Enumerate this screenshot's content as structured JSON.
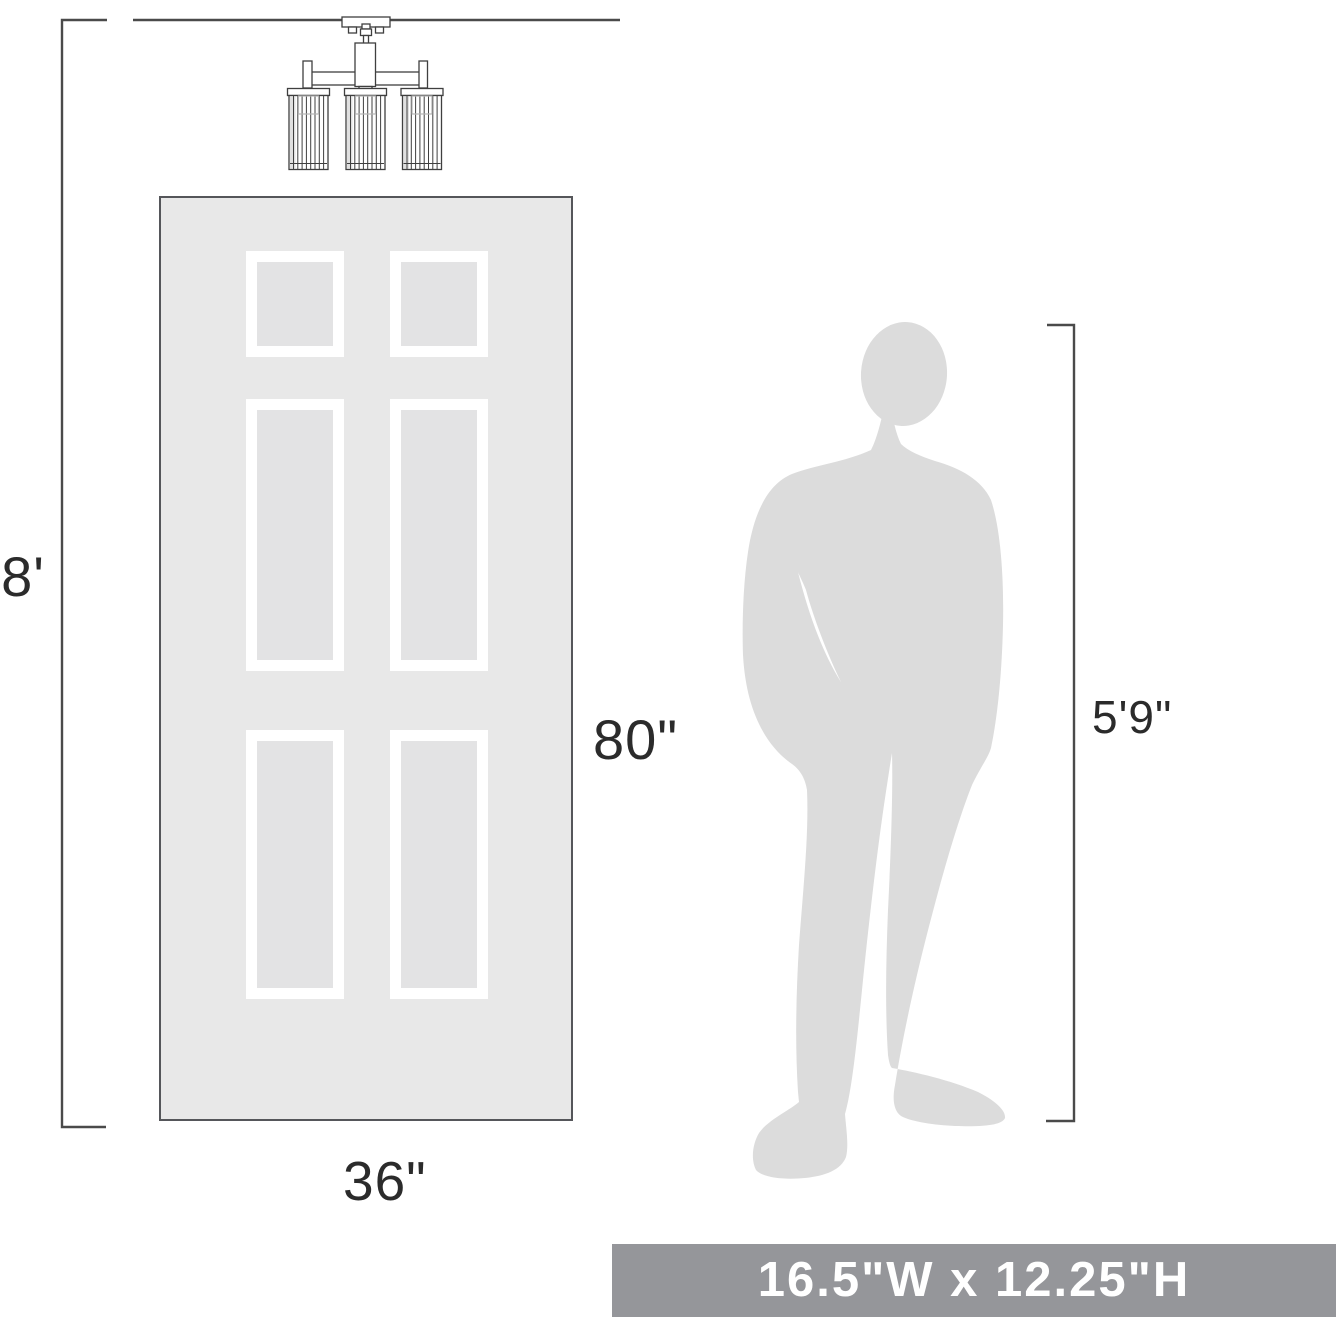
{
  "dimensions": {
    "ceiling_height": "8'",
    "door_height": "80\"",
    "door_width": "36\"",
    "person_height": "5'9\""
  },
  "banner": {
    "size_text": "16.5\"W x 12.25\"H"
  },
  "icons": {
    "fixture": "3-light-semi-flush-ceiling-fixture-drawing",
    "door": "six-panel-door-outline",
    "person": "standing-man-silhouette"
  },
  "colors": {
    "line": "#4a4a4a",
    "label_text": "#2b2b2b",
    "door_fill": "#e8e8e8",
    "door_border": "#55565a",
    "panel_frame": "#ffffff",
    "panel_inner": "#e3e3e4",
    "silhouette": "#dcdcdc",
    "banner_bg": "#95969a",
    "banner_text": "#ffffff",
    "fixture_stroke": "#3f3f3f"
  }
}
